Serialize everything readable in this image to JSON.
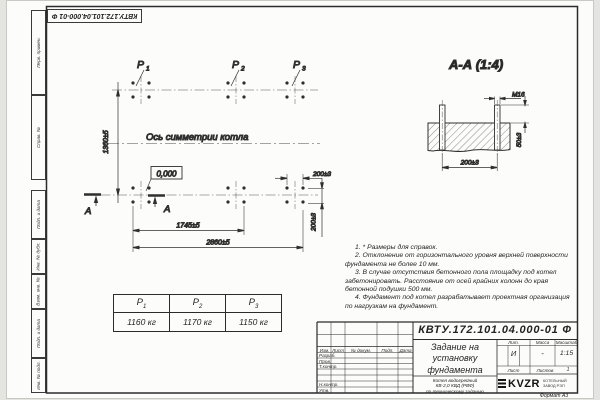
{
  "page": {
    "format_label": "Формат А3"
  },
  "stamp_top": {
    "doc_number": "КВТУ.172.101.04.000-01 Ф"
  },
  "margin_fields": {
    "f1": "Перв. примен.",
    "f2": "Справ. №",
    "f3": "Подп. и дата",
    "f4": "Инв. № дубл.",
    "f5": "Взам. инв. №",
    "f6": "Подп. и дата",
    "f7": "Инв. № подл."
  },
  "plan": {
    "p1": {
      "base": "Р",
      "sub": "1"
    },
    "p2": {
      "base": "Р",
      "sub": "2"
    },
    "p3": {
      "base": "Р",
      "sub": "3"
    },
    "axis_label": "Ось симметрии котла",
    "elevation": "0,000",
    "dim_height": "1360±5",
    "dim_span_inner": "1745±5",
    "dim_span_outer": "2860±5",
    "dim_right_horiz": "200±3",
    "dim_right_vert": "200±3",
    "section_letter_left": "А",
    "section_letter_right": "А"
  },
  "section_view": {
    "title": "А-А (1:4)",
    "thread_label": "М16",
    "dim_width": "200±3",
    "dim_height": "50±3"
  },
  "notes": {
    "n1": "1. * Размеры для справок.",
    "n2": "2. Отклонение от горизонтального уровня верхней поверхности фундамента не более 10 мм.",
    "n3": "3. В случае отсутствия бетонного пола площадку под котел забетонировать. Расстояние от осей крайних колонн до края бетонной подушки 500 мм.",
    "n4": "4. Фундамент под котел разрабатывает проектная организация по нагрузкам на фундамент."
  },
  "load_table": {
    "headers": [
      {
        "base": "Р",
        "sub": "1"
      },
      {
        "base": "Р",
        "sub": "2"
      },
      {
        "base": "Р",
        "sub": "3"
      }
    ],
    "values": [
      "1160 кг",
      "1170 кг",
      "1150 кг"
    ]
  },
  "title_block": {
    "doc_number": "КВТУ.172.101.04.000-01 Ф",
    "doc_title": "Задание на\nустановку\nфундамента",
    "product": "Котел водогрейный\nКВ-2,0 КВД (РВФ)\nпо техническому заданию",
    "col_izm": "Изм.",
    "col_list": "Лист",
    "col_ndoc": "№ докум.",
    "col_podp": "Подп.",
    "col_data": "Дата",
    "row_razrab": "Разраб.",
    "row_prov": "Пров.",
    "row_tkontr": "Т.контр.",
    "row_nkontr": "Н.контр.",
    "row_utv": "Утв.",
    "lit_label": "Лит.",
    "mass_label": "Масса",
    "scale_label": "Масштаб",
    "lit_value": "И",
    "mass_value": "-",
    "scale_value": "1:15",
    "sheet_label": "Лист",
    "sheets_label": "Листов",
    "sheets_value": "1",
    "logo_text": "KVZR",
    "logo_caption": "КОТЕЛЬНЫЙ\nЗАВОД РЭП"
  }
}
